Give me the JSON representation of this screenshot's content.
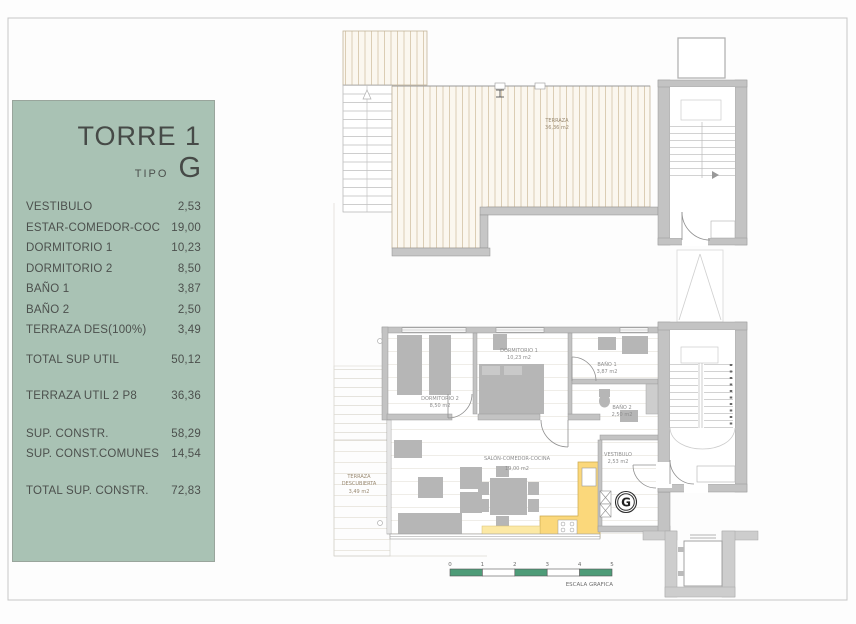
{
  "panel": {
    "title": "TORRE 1",
    "tipo_label": "TIPO",
    "tipo_value": "G",
    "rooms": [
      {
        "label": "VESTIBULO",
        "value": "2,53"
      },
      {
        "label": "ESTAR-COMEDOR-COC",
        "value": "19,00"
      },
      {
        "label": "DORMITORIO 1",
        "value": "10,23"
      },
      {
        "label": "DORMITORIO 2",
        "value": "8,50"
      },
      {
        "label": "BAÑO 1",
        "value": "3,87"
      },
      {
        "label": "BAÑO 2",
        "value": "2,50"
      },
      {
        "label": "TERRAZA DES(100%)",
        "value": "3,49"
      }
    ],
    "total_util": {
      "label": "TOTAL SUP UTIL",
      "value": "50,12"
    },
    "terraza_util": {
      "label": "TERRAZA UTIL 2 P8",
      "value": "36,36"
    },
    "constr": [
      {
        "label": "SUP. CONSTR.",
        "value": "58,29"
      },
      {
        "label": "SUP. CONST.COMUNES",
        "value": "14,54"
      }
    ],
    "total_constr": {
      "label": "TOTAL SUP. CONSTR.",
      "value": "72,83"
    }
  },
  "plan_upper": {
    "terraza_label": "TERRAZA",
    "terraza_area": "36,36 m2"
  },
  "plan_lower": {
    "dormitorio1": {
      "name": "DORMITORIO 1",
      "area": "10,23 m2"
    },
    "dormitorio2": {
      "name": "DORMITORIO 2",
      "area": "8,50 m2"
    },
    "bano1": {
      "name": "BAÑO 1",
      "area": "3,87 m2"
    },
    "bano2": {
      "name": "BAÑO 2",
      "area": "2,50 m2"
    },
    "salon": {
      "name": "SALÓN-COMEDOR-COCINA",
      "area": "19,00 m2"
    },
    "vestibulo": {
      "name": "VESTIBULO",
      "area": "2,53 m2"
    },
    "terraza_descubierta": {
      "line1": "TERRAZA",
      "line2": "DESCUBIERTA",
      "area": "3,49 m2"
    },
    "type_marker": "G"
  },
  "scale_bar": {
    "ticks": [
      "0",
      "1",
      "2",
      "3",
      "4",
      "5"
    ],
    "label": "ESCALA GRAFICA"
  },
  "colors": {
    "panel_green": "#a9c2b4",
    "kitchen_yellow": "#fbd87b",
    "kitchen_yellow_light": "#fce9a5",
    "scale_green": "#4e9c78",
    "wall_gray": "#c3c3c3"
  }
}
